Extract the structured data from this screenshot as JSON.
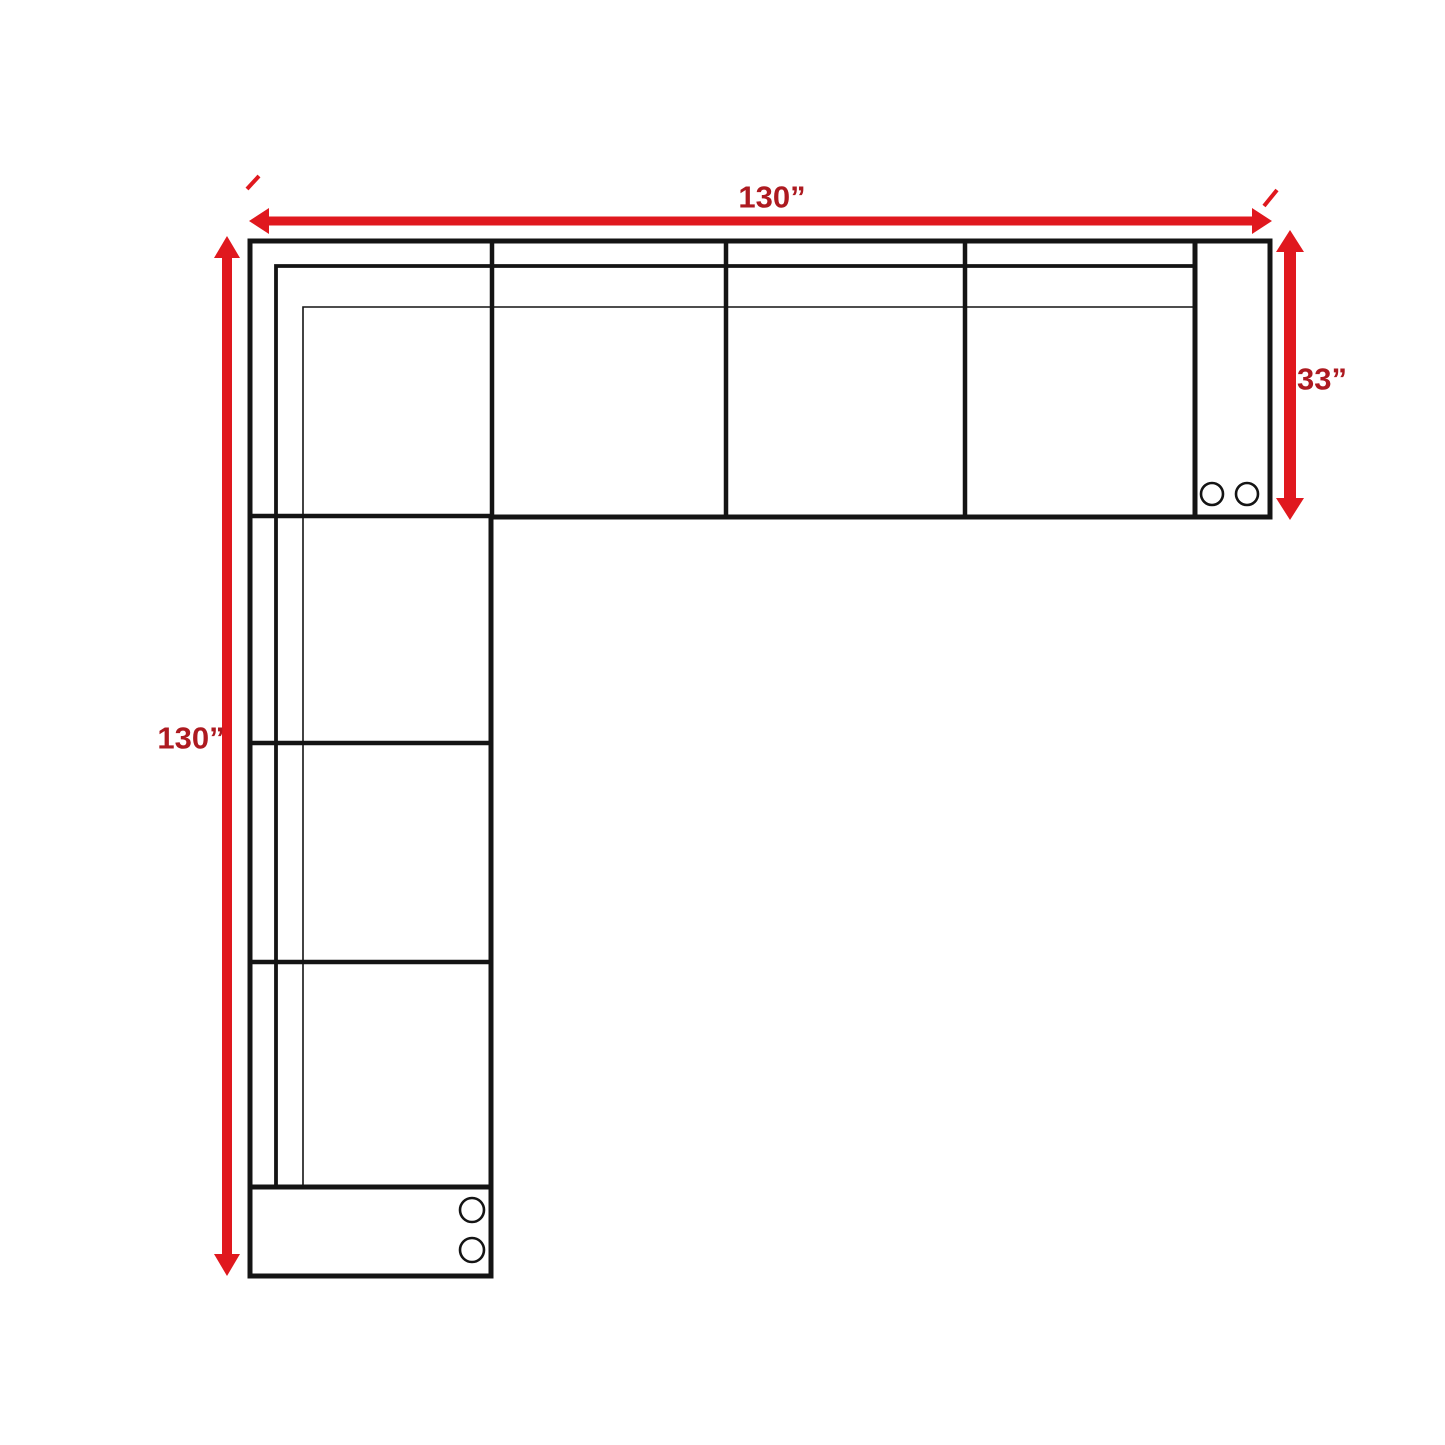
{
  "diagram": {
    "title": "sectional-sofa-top-view-dimension-diagram",
    "dimensions": {
      "top_width": "130”",
      "left_height": "130”",
      "right_depth": "33”"
    },
    "colors": {
      "arrow-red": "#e0181e",
      "label-red": "#ad1a20",
      "line-black": "#141414",
      "background": "#ffffff"
    },
    "sofa": {
      "top_row_seats": 4,
      "left_column_seats": 3,
      "right_armrest_cupholders": 2,
      "bottom_armrest_cupholders": 2
    }
  }
}
